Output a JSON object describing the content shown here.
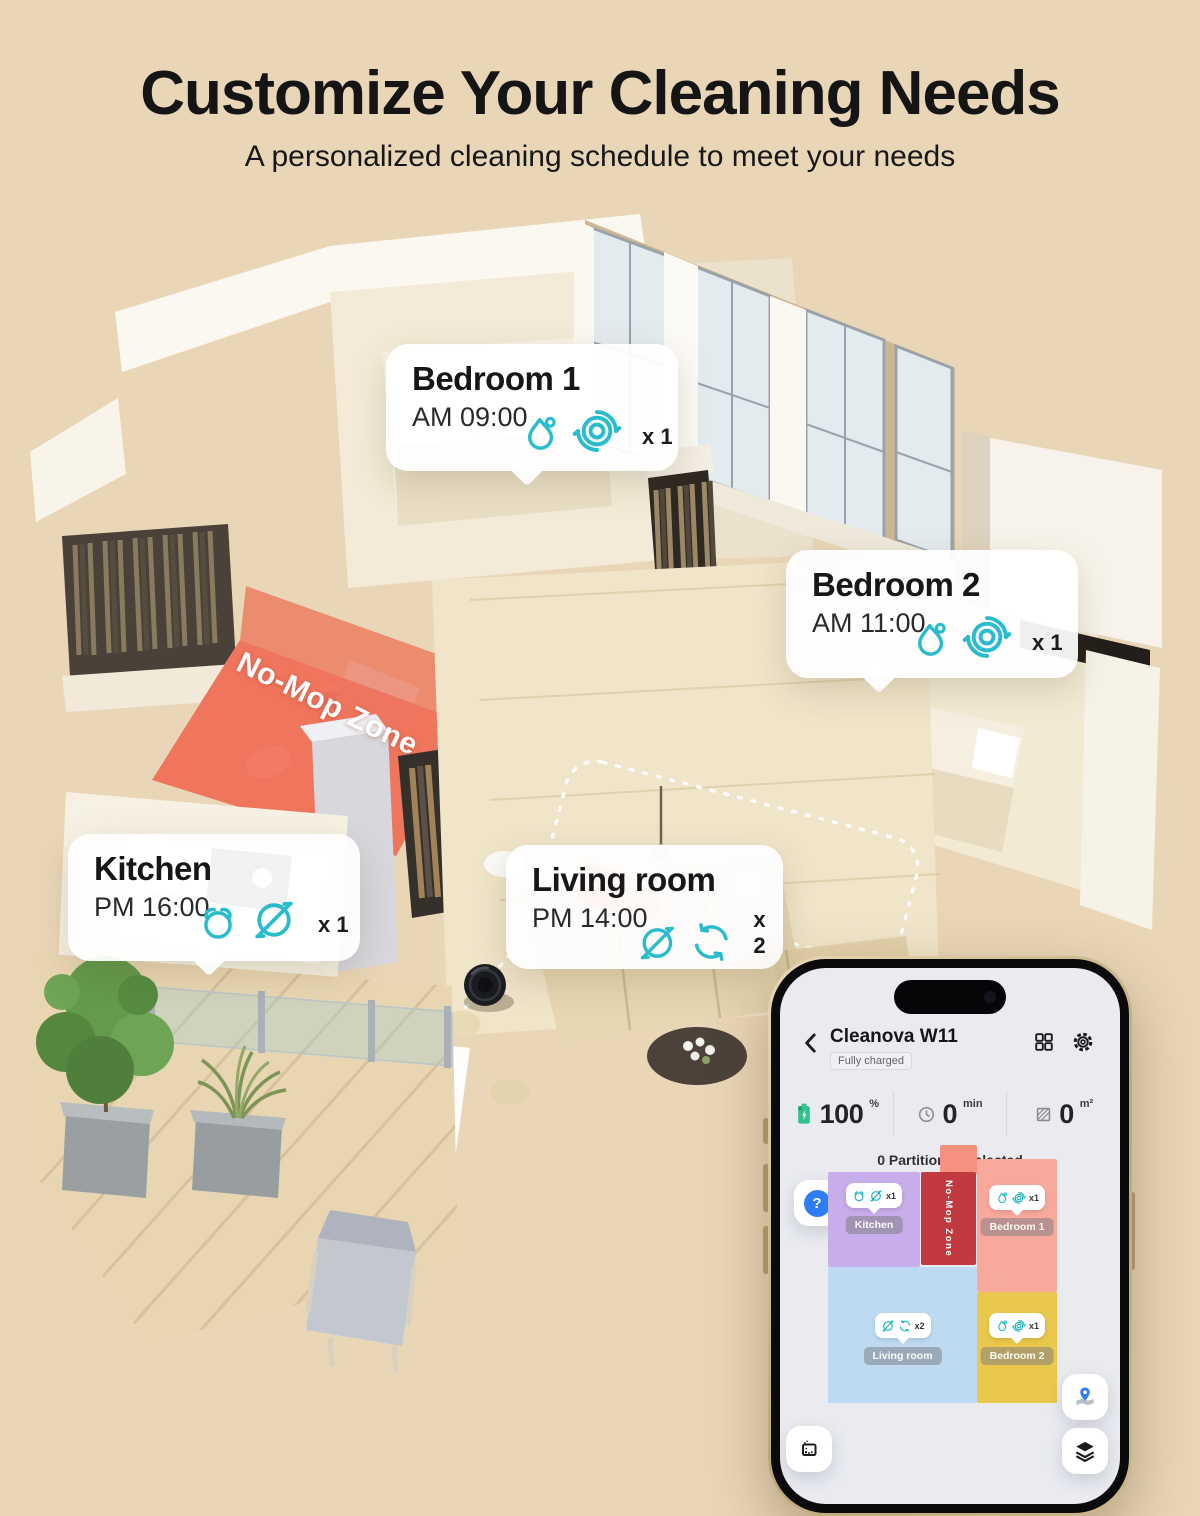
{
  "page": {
    "title": "Customize Your Cleaning Needs",
    "subtitle": "A personalized cleaning schedule to meet your needs",
    "background_color": "#e9d6b7",
    "accent_cyan": "#28bccd",
    "no_mop_red": "#ef5542"
  },
  "floorplan": {
    "no_mop_zone_label": "No-Mop Zone",
    "rooms": [
      {
        "id": "bedroom1",
        "name": "Bedroom 1",
        "time": "AM 09:00",
        "count": "x 1",
        "icons": [
          "water-drop-icon",
          "mop-disc-icon"
        ]
      },
      {
        "id": "bedroom2",
        "name": "Bedroom 2",
        "time": "AM 11:00",
        "count": "x 1",
        "icons": [
          "water-drop-icon",
          "mop-disc-icon"
        ]
      },
      {
        "id": "kitchen",
        "name": "Kitchen",
        "time": "PM 16:00",
        "count": "x 1",
        "icons": [
          "alarm-icon",
          "no-mop-icon"
        ]
      },
      {
        "id": "living",
        "name": "Living room",
        "time": "PM 14:00",
        "count": "x 2",
        "icons": [
          "no-mop-icon",
          "spin-icon"
        ]
      }
    ]
  },
  "phone": {
    "device_name": "Cleanova W11",
    "status": "Fully charged",
    "header_icons": [
      "back-chevron-icon",
      "grid-icon",
      "gear-icon"
    ],
    "stats": [
      {
        "icon": "battery-icon",
        "value": "100",
        "unit": "%"
      },
      {
        "icon": "clock-icon",
        "value": "0",
        "unit": "min"
      },
      {
        "icon": "area-icon",
        "value": "0",
        "unit": "m²"
      }
    ],
    "partition_text": "0 Partition(s) selected",
    "help_label": "?",
    "map": {
      "no_mop_zone_label": "No-Mop Zone",
      "no_mop_color": "#c13a3f",
      "stub_color": "#f5917e",
      "rooms": [
        {
          "name": "Kitchen",
          "count": "x1",
          "color": "#c7ade9",
          "icons": [
            "alarm-icon",
            "no-mop-icon"
          ]
        },
        {
          "name": "Bedroom 1",
          "count": "x1",
          "color": "#f8a99c",
          "icons": [
            "water-drop-icon",
            "mop-disc-icon"
          ]
        },
        {
          "name": "Living room",
          "count": "x2",
          "color": "#bddaf2",
          "icons": [
            "no-mop-icon",
            "spin-icon"
          ]
        },
        {
          "name": "Bedroom 2",
          "count": "x1",
          "color": "#eac84e",
          "icons": [
            "water-drop-icon",
            "mop-disc-icon"
          ]
        }
      ],
      "corner_icons": [
        "zone-select-icon",
        "map-pin-icon",
        "layers-icon"
      ]
    }
  }
}
